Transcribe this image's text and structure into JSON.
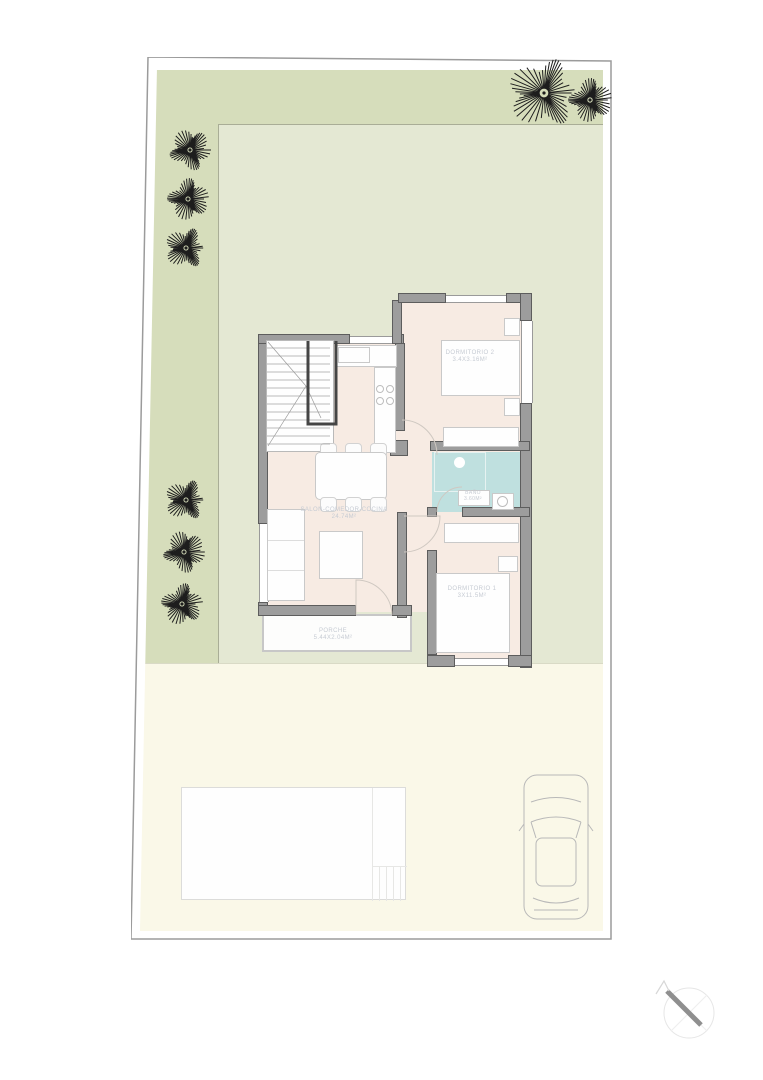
{
  "plan": {
    "rooms": {
      "salon": {
        "name": "SALON-COMEDOR-COCINA",
        "dims": "24.74m²"
      },
      "dormitorio_2": {
        "name": "DORMITORIO 2",
        "dims": "3.4x3.16m²"
      },
      "dormitorio_1": {
        "name": "DORMITORIO 1",
        "dims": "3x11.5m²"
      },
      "bano": {
        "name": "BAÑO",
        "dims": "3.60m²"
      },
      "porche": {
        "name": "PORCHE",
        "dims": "5.44x2.04m²"
      }
    },
    "icons": [
      "tree-icon",
      "car-top-view-icon",
      "north-arrow-icon"
    ]
  },
  "colors": {
    "c_garden_outer": "#d6ddbb",
    "c_garden_inner": "#e4e8d3",
    "c_ground": "#faf8e8",
    "c_floor": "#f7ebe3",
    "c_bath": "#bfe0df",
    "c_wall": "#9d9d9d",
    "c_label": "#c6cbd3"
  },
  "trees": [
    {
      "x": 544,
      "y": 93,
      "r": 36
    },
    {
      "x": 590,
      "y": 100,
      "r": 22
    },
    {
      "x": 190,
      "y": 150,
      "r": 21
    },
    {
      "x": 188,
      "y": 199,
      "r": 21
    },
    {
      "x": 186,
      "y": 248,
      "r": 21
    },
    {
      "x": 186,
      "y": 500,
      "r": 21
    },
    {
      "x": 184,
      "y": 552,
      "r": 21
    },
    {
      "x": 182,
      "y": 604,
      "r": 21
    }
  ]
}
